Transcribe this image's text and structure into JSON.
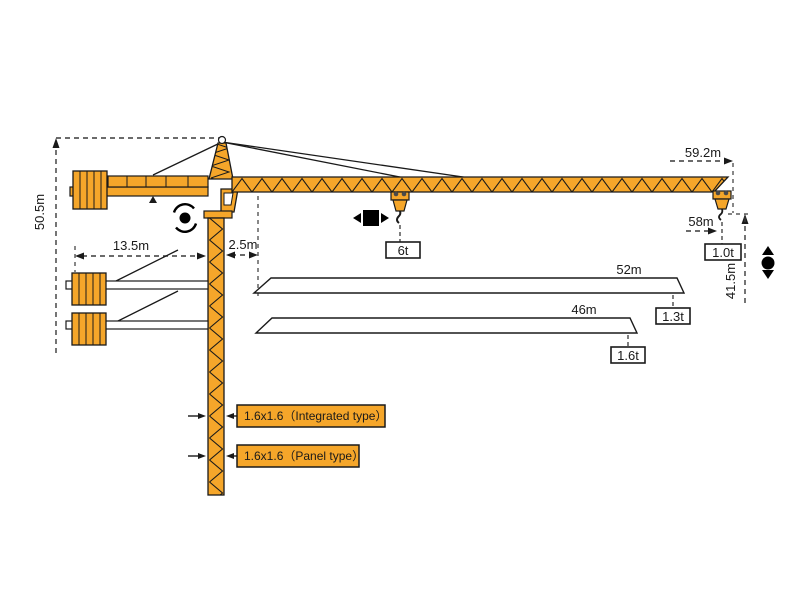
{
  "dimensions": {
    "total_height": "50.5m",
    "counterjib_radius": "13.5m",
    "root_offset": "2.5m",
    "max_jib_radius": "59.2m",
    "hook_radius": "58m",
    "lifting_height": "41.5m"
  },
  "capacities": {
    "trolley_max": "6t",
    "tip_59m": "1.0t"
  },
  "jib_options": [
    {
      "length": "52m",
      "tip_capacity": "1.3t"
    },
    {
      "length": "46m",
      "tip_capacity": "1.6t"
    }
  ],
  "mast_sections": [
    {
      "label": "1.6x1.6（Integrated type）"
    },
    {
      "label": "1.6x1.6（Panel type）"
    }
  ],
  "icons": {
    "slewing": "slewing-rotation",
    "trolley": "trolley-travel",
    "hoist": "hook-hoisting"
  },
  "colors": {
    "crane_orange": "#F5A62A",
    "outline": "#1A1A1A",
    "dimension_line": "#3A3A3A",
    "background": "#FFFFFF"
  }
}
